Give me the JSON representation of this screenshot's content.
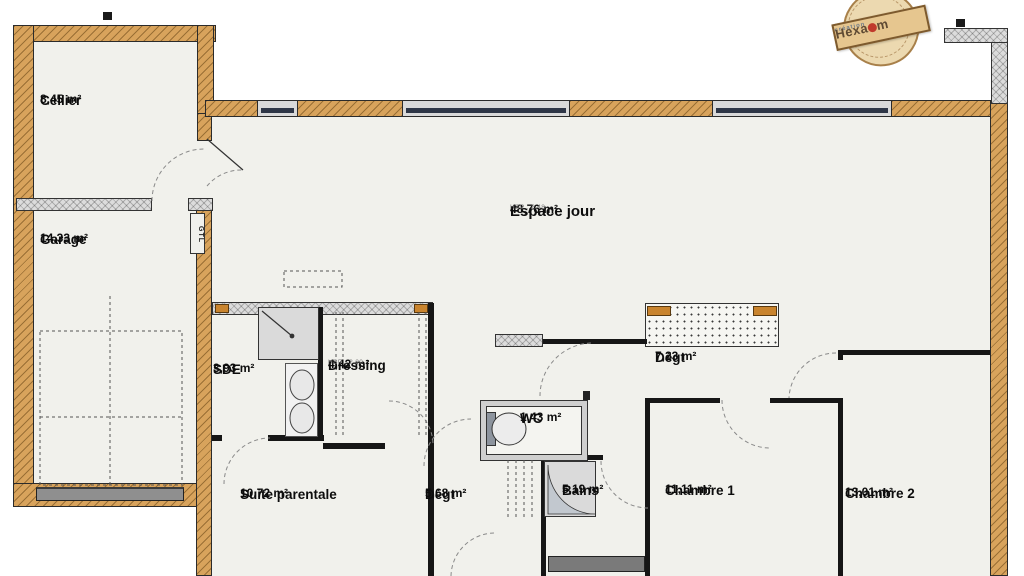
{
  "rooms": [
    {
      "name": "Cellier",
      "area": "8,45 m²"
    },
    {
      "name": "Garage",
      "area": "14,33 m²"
    },
    {
      "name": "Espace jour",
      "area": "48,76 m²",
      "note": "HSP : 2.48"
    },
    {
      "name": "SDE",
      "area": "3,93 m²"
    },
    {
      "name": "Dressing",
      "area": "4,42 m²",
      "note": "HSP : 2.20"
    },
    {
      "name": "Dégt",
      "area": "7,23 m²"
    },
    {
      "name": "WC",
      "area": "1,43 m²"
    },
    {
      "name": "Bains",
      "area": "5,19 m²"
    },
    {
      "name": "Suite parentale",
      "area": "10,72 m²"
    },
    {
      "name": "Dégt",
      "area": "5,68 m²"
    },
    {
      "name": "Chambre 1",
      "area": "11,11 m²"
    },
    {
      "name": "Chambre 2",
      "area": "13,01 m²"
    }
  ],
  "annotations": {
    "gtl": "GTL"
  },
  "stamp": {
    "tagline": "création",
    "brand_start": "Hexa",
    "brand_end": "m"
  },
  "colors": {
    "exterior_wall": "#d8a35c",
    "window_glass": "#2e3647",
    "floor": "#f1f1ec",
    "stamp_red": "#c0392b"
  }
}
